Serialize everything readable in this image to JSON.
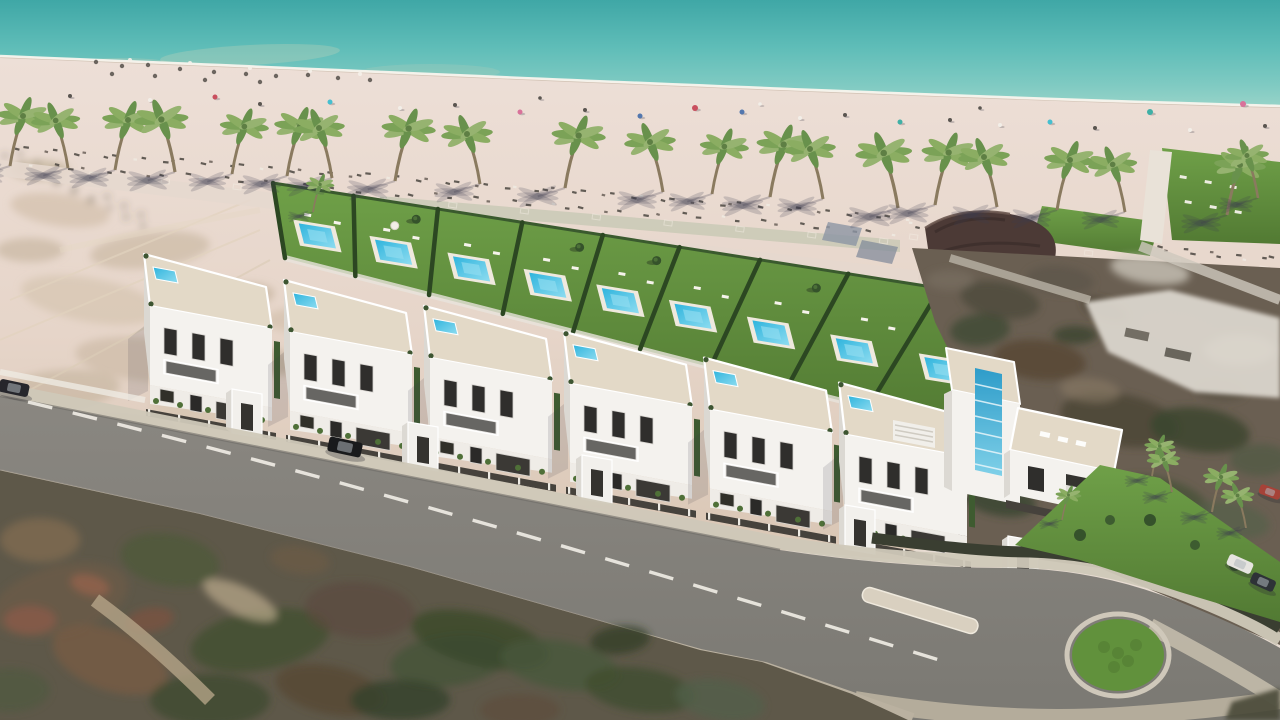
{
  "scene": {
    "kind": "aerial-3d-architectural-render",
    "subject": "beachfront-townhouse-development",
    "width": 1280,
    "height": 720,
    "elements": [
      "sea",
      "beach",
      "palm-row",
      "garden-plots-with-pools",
      "white-villas",
      "street",
      "roundabout",
      "existing-neighborhood",
      "scrubland"
    ]
  },
  "palette": {
    "sea_deep": "#3FA7A6",
    "sea_mid": "#5FBDB8",
    "sea_shallow": "#85CCC3",
    "foam": "#F8F4ED",
    "wet_sand": "#CFC0B2",
    "sand_light": "#EDDFD7",
    "sand_warm": "#E2CFC2",
    "dune": "#D5C3AC",
    "promenade": "#E6D8CE",
    "boardwalk": "#BCC3AC",
    "lawn": "#6FA048",
    "lawn_dark": "#527A33",
    "hedge": "#2C4722",
    "pool": "#2FB4DD",
    "pool_light": "#8EDCF0",
    "facade": "#F4F2EE",
    "facade_shade": "#DBD8D2",
    "terrace": "#E3D9C7",
    "window": "#2F2E2C",
    "fence": "#46423C",
    "road": "#83807A",
    "sidewalk": "#C9C1B1",
    "curb": "#BAB1A0",
    "dash": "#EFECE4",
    "island_green": "#61913C",
    "bar_roof": "#4C3A36",
    "palm_leaf": "#7BA257",
    "palm_trunk": "#8A7A5F",
    "scrub": "#5E5849",
    "neighborhood": "#6A5F52",
    "white_complex": "#DED9D0"
  },
  "counts": {
    "beach_palms": 22,
    "villa_clusters": 6,
    "garden_plots": 9,
    "pools": 9,
    "cars": 5,
    "roundabouts": 1
  },
  "palms": [
    [
      10,
      166,
      1.0,
      1
    ],
    [
      68,
      168,
      0.95,
      -1
    ],
    [
      115,
      170,
      1.0,
      1
    ],
    [
      175,
      172,
      1.05,
      -1
    ],
    [
      232,
      174,
      0.95,
      1
    ],
    [
      287,
      176,
      1.0,
      1
    ],
    [
      332,
      178,
      1.0,
      -1
    ],
    [
      395,
      181,
      1.05,
      1
    ],
    [
      480,
      184,
      1.0,
      -1
    ],
    [
      565,
      188,
      1.05,
      1
    ],
    [
      663,
      192,
      1.0,
      -1
    ],
    [
      712,
      194,
      0.95,
      1
    ],
    [
      770,
      197,
      1.05,
      1
    ],
    [
      823,
      199,
      1.0,
      -1
    ],
    [
      898,
      208,
      1.1,
      -1
    ],
    [
      935,
      205,
      1.05,
      1
    ],
    [
      997,
      207,
      1.0,
      -1
    ],
    [
      1057,
      210,
      1.0,
      1
    ],
    [
      1125,
      212,
      0.95,
      -1
    ],
    [
      1227,
      215,
      1.0,
      1
    ],
    [
      1258,
      198,
      0.85,
      -1
    ],
    [
      313,
      212,
      0.55,
      1
    ]
  ],
  "road_palms": [
    [
      1152,
      476,
      0.6,
      1
    ],
    [
      1172,
      492,
      0.65,
      -1
    ],
    [
      1212,
      512,
      0.7,
      1
    ],
    [
      1246,
      528,
      0.65,
      -1
    ],
    [
      1062,
      520,
      0.5,
      1
    ]
  ],
  "beach_items": [
    [
      70,
      96,
      "#5A5550",
      2
    ],
    [
      150,
      100,
      "#F2EEE8",
      2
    ],
    [
      215,
      97,
      "#C94F5E",
      2.5
    ],
    [
      260,
      104,
      "#5A5550",
      2
    ],
    [
      330,
      102,
      "#45BFD0",
      2.5
    ],
    [
      400,
      108,
      "#F2EEE8",
      2
    ],
    [
      455,
      105,
      "#5A5550",
      2
    ],
    [
      520,
      112,
      "#D9729A",
      2.5
    ],
    [
      585,
      110,
      "#5A5550",
      2
    ],
    [
      640,
      116,
      "#5377AE",
      2.5
    ],
    [
      695,
      108,
      "#C94F5E",
      3
    ],
    [
      742,
      112,
      "#5377AE",
      2.5
    ],
    [
      800,
      118,
      "#F2EEE8",
      2
    ],
    [
      845,
      115,
      "#5A5550",
      2
    ],
    [
      900,
      122,
      "#3FB0A6",
      2.5
    ],
    [
      950,
      120,
      "#5A5550",
      2
    ],
    [
      1000,
      125,
      "#F2EEE8",
      2
    ],
    [
      1050,
      122,
      "#45BFD0",
      2.5
    ],
    [
      1095,
      128,
      "#5A5550",
      2
    ],
    [
      1150,
      112,
      "#3FB0A6",
      3
    ],
    [
      1190,
      130,
      "#F2EEE8",
      2
    ],
    [
      1243,
      104,
      "#D9729A",
      3
    ],
    [
      1265,
      126,
      "#5A5550",
      2
    ],
    [
      540,
      98,
      "#5A5550",
      1.8
    ],
    [
      760,
      104,
      "#F2EEE8",
      1.8
    ],
    [
      980,
      108,
      "#5A5550",
      1.8
    ]
  ],
  "debris": {
    "dark": [
      [
        96,
        62
      ],
      [
        122,
        66
      ],
      [
        148,
        65
      ],
      [
        180,
        69
      ],
      [
        214,
        72
      ],
      [
        246,
        74
      ],
      [
        276,
        76
      ],
      [
        308,
        75
      ],
      [
        338,
        78
      ],
      [
        370,
        80
      ],
      [
        112,
        74
      ],
      [
        205,
        80
      ],
      [
        260,
        82
      ],
      [
        155,
        76
      ]
    ],
    "white": [
      [
        130,
        60
      ],
      [
        190,
        63
      ],
      [
        250,
        68
      ],
      [
        310,
        71
      ],
      [
        360,
        74
      ]
    ]
  },
  "sunbed_lines": [
    {
      "x1": 0,
      "y1": 146,
      "x2": 900,
      "y2": 216,
      "n": 64
    },
    {
      "x1": 30,
      "y1": 163,
      "x2": 890,
      "y2": 231,
      "n": 46
    },
    {
      "x1": 905,
      "y1": 222,
      "x2": 1270,
      "y2": 258,
      "n": 30
    }
  ],
  "pave_lines": [
    {
      "x1": 90,
      "y1": 172,
      "x2": 880,
      "y2": 238,
      "n": 12
    },
    {
      "x1": 910,
      "y1": 234,
      "x2": 1260,
      "y2": 266,
      "n": 5
    }
  ],
  "garden": {
    "band": {
      "A": [
        273,
        183
      ],
      "B": [
        1040,
        304
      ],
      "C": [
        955,
        430
      ],
      "D": [
        285,
        258
      ]
    },
    "dividers": [
      0,
      0.105,
      0.215,
      0.325,
      0.43,
      0.53,
      0.635,
      0.75,
      0.87,
      1
    ],
    "plots": [
      {
        "pool": true,
        "tree": false,
        "umbrella": false
      },
      {
        "pool": true,
        "tree": true,
        "umbrella": true
      },
      {
        "pool": true,
        "tree": false,
        "umbrella": false
      },
      {
        "pool": true,
        "tree": true,
        "umbrella": false
      },
      {
        "pool": true,
        "tree": true,
        "umbrella": false
      },
      {
        "pool": true,
        "tree": false,
        "umbrella": false
      },
      {
        "pool": true,
        "tree": true,
        "umbrella": false
      },
      {
        "pool": true,
        "tree": false,
        "umbrella": false
      },
      {
        "pool": true,
        "tree": true,
        "umbrella": false
      }
    ]
  },
  "villas": {
    "anchors": [
      [
        150,
        385,
        1
      ],
      [
        290,
        410.9,
        1
      ],
      [
        430,
        436.8,
        1
      ],
      [
        570,
        462.7,
        1
      ],
      [
        710,
        488.6,
        1
      ],
      [
        845,
        513.6,
        1
      ]
    ],
    "porches": [
      [
        232,
        433
      ],
      [
        408,
        466
      ],
      [
        582,
        499
      ],
      [
        845,
        549
      ],
      [
        1008,
        580
      ]
    ]
  },
  "cars": [
    [
      345,
      447,
      12,
      "#191A1C",
      34,
      15
    ],
    [
      14,
      388,
      12,
      "#26262C",
      30,
      13
    ],
    [
      1240,
      564,
      24,
      "#E6E4E0",
      26,
      12
    ],
    [
      1263,
      582,
      24,
      "#2E3237",
      25,
      12
    ],
    [
      1270,
      492,
      20,
      "#A64238",
      22,
      10
    ]
  ],
  "roundabout": {
    "cx": 1118,
    "cy": 655,
    "rx": 46,
    "ry": 36
  },
  "splitter_island": {
    "x": 860,
    "y": 603,
    "w": 120,
    "h": 15,
    "rot": 17,
    "cx": 920,
    "cy": 611
  },
  "club": {
    "loungers": [
      [
        1180,
        175
      ],
      [
        1205,
        180
      ],
      [
        1230,
        185
      ],
      [
        1185,
        200
      ],
      [
        1210,
        205
      ],
      [
        1235,
        210
      ]
    ],
    "parking": [
      [
        985,
        262
      ],
      [
        1005,
        266
      ],
      [
        1025,
        270
      ],
      [
        1045,
        274
      ],
      [
        1065,
        278
      ],
      [
        1085,
        282
      ],
      [
        1010,
        286
      ],
      [
        1030,
        290
      ],
      [
        1050,
        294
      ]
    ]
  },
  "blobs": {
    "dune": [
      [
        60,
        210,
        50,
        16,
        8,
        "#C9B69E",
        0.5
      ],
      [
        150,
        250,
        60,
        18,
        -6,
        "#BFAE94",
        0.5
      ],
      [
        90,
        300,
        70,
        22,
        10,
        "#CDBBA1",
        0.45
      ],
      [
        220,
        300,
        55,
        16,
        -8,
        "#B7A68C",
        0.5
      ],
      [
        150,
        360,
        75,
        22,
        6,
        "#C4B199",
        0.5
      ],
      [
        60,
        390,
        60,
        20,
        -5,
        "#B9A88F",
        0.45
      ],
      [
        260,
        360,
        40,
        14,
        10,
        "#AE9D84",
        0.5
      ],
      [
        40,
        170,
        30,
        10,
        0,
        "#A89878",
        0.45
      ],
      [
        300,
        320,
        36,
        12,
        0,
        "#C2AF95",
        0.4
      ],
      [
        200,
        410,
        50,
        16,
        6,
        "#CEBCA2",
        0.4
      ],
      [
        120,
        430,
        60,
        18,
        4,
        "#C8B59B",
        0.4
      ],
      [
        30,
        250,
        34,
        12,
        0,
        "#B5A489",
        0.45
      ]
    ],
    "bottom_left": [
      [
        60,
        600,
        70,
        34,
        -15,
        "#6B5B49",
        0.8
      ],
      [
        170,
        560,
        50,
        26,
        10,
        "#4C5A38",
        0.7
      ],
      [
        110,
        660,
        60,
        30,
        20,
        "#7A5B45",
        0.7
      ],
      [
        260,
        640,
        70,
        30,
        -10,
        "#42502F",
        0.8
      ],
      [
        360,
        610,
        55,
        28,
        5,
        "#5C4A3E",
        0.7
      ],
      [
        40,
        540,
        40,
        22,
        0,
        "#8A6F52",
        0.6
      ],
      [
        210,
        700,
        60,
        26,
        0,
        "#3E4A2E",
        0.8
      ],
      [
        330,
        690,
        55,
        24,
        12,
        "#564633",
        0.75
      ],
      [
        450,
        660,
        60,
        26,
        -8,
        "#46543A",
        0.8
      ],
      [
        30,
        620,
        26,
        14,
        0,
        "#8A5A48",
        0.8
      ],
      [
        90,
        585,
        20,
        10,
        15,
        "#93624C",
        0.8
      ],
      [
        150,
        620,
        24,
        12,
        -10,
        "#7E523F",
        0.7
      ],
      [
        240,
        600,
        40,
        14,
        25,
        "#BBA98C",
        0.7
      ],
      [
        480,
        640,
        70,
        26,
        14,
        "#3C4A2C",
        0.85
      ],
      [
        560,
        665,
        60,
        24,
        10,
        "#49583B",
        0.8
      ],
      [
        640,
        690,
        55,
        22,
        8,
        "#404E30",
        0.8
      ],
      [
        720,
        700,
        45,
        20,
        10,
        "#53604A",
        0.75
      ],
      [
        400,
        700,
        50,
        20,
        0,
        "#35422A",
        0.8
      ],
      [
        520,
        710,
        40,
        16,
        0,
        "#5E4C3C",
        0.7
      ],
      [
        10,
        690,
        40,
        22,
        0,
        "#4E5A40",
        0.7
      ],
      [
        300,
        560,
        30,
        14,
        8,
        "#6E5A46",
        0.6
      ],
      [
        620,
        640,
        30,
        14,
        -6,
        "#2F3B24",
        0.7
      ]
    ],
    "right": [
      [
        1000,
        300,
        40,
        18,
        10,
        "#4E4A3C",
        0.8
      ],
      [
        1060,
        280,
        34,
        14,
        5,
        "#5C5548",
        0.7
      ],
      [
        1150,
        270,
        40,
        14,
        8,
        "#CFC9BE",
        0.75
      ],
      [
        980,
        330,
        30,
        16,
        -5,
        "#3F4A33",
        0.8
      ],
      [
        1040,
        360,
        46,
        20,
        6,
        "#55412E",
        0.7
      ],
      [
        1120,
        420,
        60,
        26,
        10,
        "#4A4636",
        0.8
      ],
      [
        1200,
        430,
        50,
        22,
        8,
        "#3C462F",
        0.85
      ],
      [
        1060,
        460,
        44,
        20,
        12,
        "#5E4A40",
        0.7
      ],
      [
        1160,
        500,
        50,
        22,
        14,
        "#47533A",
        0.8
      ],
      [
        1230,
        520,
        40,
        18,
        10,
        "#55604A",
        0.7
      ],
      [
        980,
        420,
        36,
        18,
        8,
        "#6B5D4E",
        0.65
      ],
      [
        1240,
        350,
        36,
        16,
        0,
        "#C9C2B4",
        0.6
      ],
      [
        1090,
        390,
        30,
        12,
        6,
        "#8A7A66",
        0.6
      ],
      [
        1000,
        500,
        36,
        16,
        10,
        "#3A4430",
        0.8
      ],
      [
        1260,
        460,
        30,
        16,
        0,
        "#4E5A42",
        0.7
      ],
      [
        1180,
        330,
        40,
        14,
        12,
        "#6E6557",
        0.6
      ],
      [
        950,
        280,
        24,
        10,
        0,
        "#7A7264",
        0.6
      ],
      [
        1105,
        310,
        24,
        10,
        20,
        "#423A2E",
        0.7
      ],
      [
        1075,
        335,
        22,
        9,
        0,
        "#35402B",
        0.7
      ],
      [
        1220,
        390,
        26,
        11,
        6,
        "#565041",
        0.6
      ]
    ]
  }
}
